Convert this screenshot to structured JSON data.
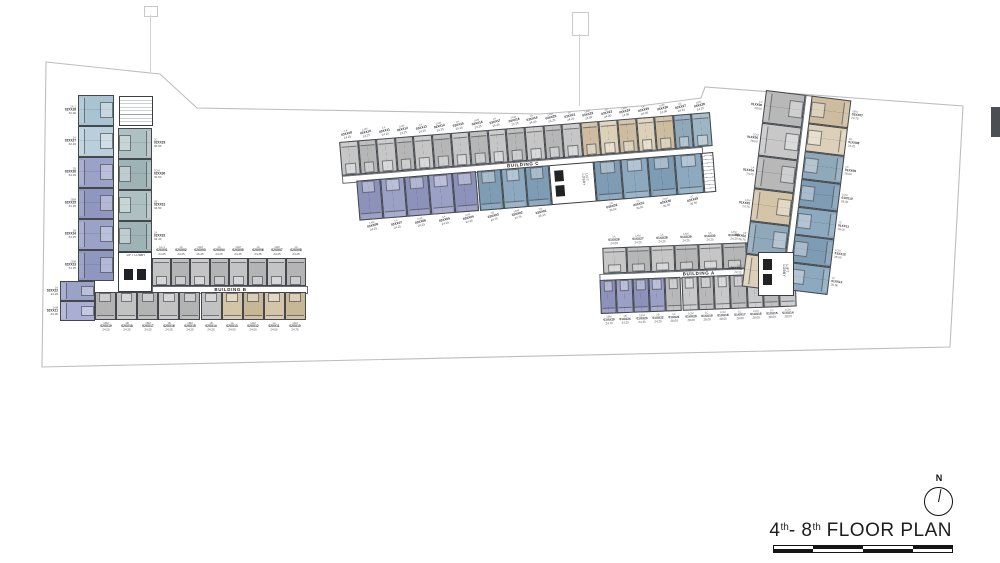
{
  "title": {
    "n1": "4",
    "s1": "th",
    "n2": "- 8",
    "s2": "th",
    "rest": " FLOOR PLAN"
  },
  "compass": {
    "north": "N"
  },
  "buildings": {
    "b": {
      "label": "BUILDING B",
      "lobby_label": "LIFT LOBBY",
      "left_units": [
        {
          "type": "2A-1",
          "no": "02XX28",
          "area": "32.00",
          "color": "#a9c3d2"
        },
        {
          "type": "2A",
          "no": "02XX27",
          "area": "32.40",
          "color": "#b9cfdc"
        },
        {
          "type": "2B",
          "no": "02XX26",
          "area": "34.25",
          "color": "#9aa2c8"
        },
        {
          "type": "2BM",
          "no": "02XX25",
          "area": "34.25",
          "color": "#8f96c0"
        },
        {
          "type": "2B",
          "no": "02XX24",
          "area": "34.25",
          "color": "#9aa2c8"
        },
        {
          "type": "2BM",
          "no": "02XX23",
          "area": "34.25",
          "color": "#8f96c0"
        }
      ],
      "corner_units": [
        {
          "type": "1A",
          "no": "02XX22",
          "area": "24.25",
          "color": "#9aa2c8"
        },
        {
          "type": "1AM",
          "no": "02XX21",
          "area": "24.00",
          "color": "#a9aed2"
        }
      ],
      "right_units": [
        {
          "type": "2C",
          "no": "02XX29",
          "area": "30.50",
          "color": "#aec0c1"
        },
        {
          "type": "2CM",
          "no": "02XX30",
          "area": "30.50",
          "color": "#9db3b6"
        },
        {
          "type": "2B",
          "no": "02XX31",
          "area": "34.50",
          "color": "#aec0c1"
        },
        {
          "type": "2A",
          "no": "02XX32",
          "area": "32.40",
          "color": "#9db3b6"
        }
      ],
      "top_row": [
        {
          "type": "1A-1",
          "no": "02XX01",
          "area": "24.25",
          "color": "#c4c4c4"
        },
        {
          "type": "1A",
          "no": "02XX02",
          "area": "24.25",
          "color": "#b4b4b4"
        },
        {
          "type": "1AM",
          "no": "02XX03",
          "area": "26.25",
          "color": "#c4c4c4"
        },
        {
          "type": "1A",
          "no": "02XX04",
          "area": "24.25",
          "color": "#b4b4b4"
        },
        {
          "type": "1AM",
          "no": "02XX05",
          "area": "24.25",
          "color": "#c4c4c4"
        },
        {
          "type": "1A",
          "no": "02XX06",
          "area": "24.25",
          "color": "#b4b4b4"
        },
        {
          "type": "1AM",
          "no": "02XX07",
          "area": "24.25",
          "color": "#c4c4c4"
        },
        {
          "type": "1A",
          "no": "02XX08",
          "area": "24.25",
          "color": "#b4b4b4"
        }
      ],
      "bottom_row": [
        {
          "type": "1BM",
          "no": "02XX19",
          "area": "24.25",
          "color": "#b3b3b3"
        },
        {
          "type": "1B",
          "no": "02XX18",
          "area": "24.25",
          "color": "#c2c2c2"
        },
        {
          "type": "1BM",
          "no": "02XX17",
          "area": "24.25",
          "color": "#b3b3b3"
        },
        {
          "type": "1B",
          "no": "02XX16",
          "area": "24.25",
          "color": "#c2c2c2"
        },
        {
          "type": "1BM",
          "no": "02XX15",
          "area": "24.25",
          "color": "#b3b3b3"
        },
        {
          "type": "1B",
          "no": "02XX14",
          "area": "24.25",
          "color": "#c2c2c2"
        },
        {
          "type": "1A",
          "no": "02XX13",
          "area": "24.00",
          "color": "#d5c5a8"
        },
        {
          "type": "1AM",
          "no": "02XX12",
          "area": "24.00",
          "color": "#c8b795"
        },
        {
          "type": "1A",
          "no": "02XX11",
          "area": "24.00",
          "color": "#d5c5a8"
        },
        {
          "type": "1AM",
          "no": "02XX10",
          "area": "24.75",
          "color": "#c8b795"
        }
      ]
    },
    "c": {
      "label": "BUILDING C",
      "lobby_label": "LIFT LOBBY",
      "top_row": [
        {
          "type": "1A",
          "no": "03XX09",
          "area": "24.25",
          "color": "#c6c6c6"
        },
        {
          "type": "1AM",
          "no": "03XX10",
          "area": "24.25",
          "color": "#b6b6b6"
        },
        {
          "type": "1A",
          "no": "03XX11",
          "area": "24.25",
          "color": "#c6c6c6"
        },
        {
          "type": "1AM",
          "no": "03XX12",
          "area": "24.25",
          "color": "#b6b6b6"
        },
        {
          "type": "1A",
          "no": "03XX13",
          "area": "24.25",
          "color": "#c6c6c6"
        },
        {
          "type": "1AM",
          "no": "03XX14",
          "area": "24.25",
          "color": "#b6b6b6"
        },
        {
          "type": "1A",
          "no": "03XX15",
          "area": "24.25",
          "color": "#c6c6c6"
        },
        {
          "type": "1AM",
          "no": "03XX16",
          "area": "24.25",
          "color": "#b6b6b6"
        },
        {
          "type": "1A",
          "no": "03XX17",
          "area": "24.25",
          "color": "#c6c6c6"
        },
        {
          "type": "1AM",
          "no": "03XX18",
          "area": "24.25",
          "color": "#b6b6b6"
        },
        {
          "type": "1A",
          "no": "03XX19",
          "area": "24.25",
          "color": "#c6c6c6"
        },
        {
          "type": "1AM",
          "no": "03XX20",
          "area": "24.25",
          "color": "#b6b6b6"
        },
        {
          "type": "1A",
          "no": "03XX21",
          "area": "24.25",
          "color": "#c6c6c6"
        },
        {
          "type": "1AM",
          "no": "03XX22",
          "area": "24.00",
          "color": "#cdbc9f"
        },
        {
          "type": "1A",
          "no": "03XX23",
          "area": "24.00",
          "color": "#ddd0b8"
        },
        {
          "type": "1AM",
          "no": "03XX24",
          "area": "24.00",
          "color": "#cdbc9f"
        },
        {
          "type": "1A",
          "no": "03XX25",
          "area": "24.00",
          "color": "#ddd0b8"
        },
        {
          "type": "1AM",
          "no": "03XX26",
          "area": "24.00",
          "color": "#cdbc9f"
        },
        {
          "type": "1B",
          "no": "03XX27",
          "area": "24.25",
          "color": "#8fa9ba"
        },
        {
          "type": "1BM",
          "no": "03XX28",
          "area": "24.25",
          "color": "#9db6c4"
        }
      ],
      "bottom_left": [
        {
          "type": "1AM",
          "no": "03XX08",
          "area": "24.25",
          "color": "#8d92bb"
        },
        {
          "type": "1A",
          "no": "03XX07",
          "area": "24.25",
          "color": "#9aa0c6"
        },
        {
          "type": "1AM",
          "no": "03XX06",
          "area": "24.25",
          "color": "#8d92bb"
        },
        {
          "type": "1A",
          "no": "03XX05",
          "area": "24.25",
          "color": "#9aa0c6"
        },
        {
          "type": "1AM",
          "no": "03XX04",
          "area": "24.25",
          "color": "#8d92bb"
        },
        {
          "type": "1B",
          "no": "03XX03",
          "area": "24.75",
          "color": "#7e9cb4"
        },
        {
          "type": "1BM",
          "no": "03XX02",
          "area": "24.75",
          "color": "#8ca9bf"
        },
        {
          "type": "2B",
          "no": "03XX01",
          "area": "26.25",
          "color": "#7e9cb4"
        }
      ],
      "bottom_right": [
        {
          "type": "2C",
          "no": "03XX32",
          "area": "30.50",
          "color": "#7e9cb4"
        },
        {
          "type": "2C",
          "no": "03XX31",
          "area": "30.50",
          "color": "#8ca9bf"
        },
        {
          "type": "2CM",
          "no": "03XX30",
          "area": "30.50",
          "color": "#7e9cb4"
        },
        {
          "type": "2C",
          "no": "03XX29",
          "area": "30.50",
          "color": "#8ca9bf"
        }
      ]
    },
    "a": {
      "label": "BUILDING A",
      "lobby_label": "LIFT LOBBY",
      "bar_top": [
        {
          "type": "1A",
          "no": "01XX26",
          "area": "24.00",
          "color": "#c6c6c6"
        },
        {
          "type": "1AM",
          "no": "01XX27",
          "area": "24.25",
          "color": "#b6b6b6"
        },
        {
          "type": "1A",
          "no": "01XX28",
          "area": "24.25",
          "color": "#c6c6c6"
        },
        {
          "type": "1AM",
          "no": "01XX29",
          "area": "24.25",
          "color": "#b6b6b6"
        },
        {
          "type": "1A",
          "no": "01XX30",
          "area": "24.25",
          "color": "#c6c6c6"
        },
        {
          "type": "1AM",
          "no": "01XX31",
          "area": "24.25",
          "color": "#b6b6b6"
        },
        {
          "type": "1B",
          "no": "01XX32",
          "area": "24.75",
          "color": "#8fa9ba"
        },
        {
          "type": "1BM",
          "no": "01XX33",
          "area": "24.75",
          "color": "#d5c5a8"
        }
      ],
      "bar_bottom": [
        {
          "type": "1BM",
          "no": "01XX25",
          "area": "24.75",
          "color": "#8d92bb"
        },
        {
          "type": "1B",
          "no": "01XX24",
          "area": "24.25",
          "color": "#9aa0c6"
        },
        {
          "type": "1BM",
          "no": "01XX23",
          "area": "24.25",
          "color": "#8d92bb"
        },
        {
          "type": "1B",
          "no": "01XX22",
          "area": "24.25",
          "color": "#9aa0c6"
        },
        {
          "type": "1C",
          "no": "01XX21",
          "area": "28.00",
          "color": "#b8b8b8"
        },
        {
          "type": "1CM",
          "no": "01XX20",
          "area": "28.00",
          "color": "#c8c8c8"
        },
        {
          "type": "1C",
          "no": "01XX19",
          "area": "28.00",
          "color": "#b8b8b8"
        },
        {
          "type": "1CM",
          "no": "01XX18",
          "area": "28.00",
          "color": "#c8c8c8"
        },
        {
          "type": "1C",
          "no": "01XX17",
          "area": "28.00",
          "color": "#b8b8b8"
        },
        {
          "type": "1CM",
          "no": "01XX16",
          "area": "28.00",
          "color": "#c8c8c8"
        },
        {
          "type": "1C",
          "no": "01XX15",
          "area": "28.00",
          "color": "#b8b8b8"
        },
        {
          "type": "1CM",
          "no": "01XX14",
          "area": "28.00",
          "color": "#c8c8c8"
        }
      ],
      "wing_left": [
        {
          "type": "1C",
          "no": "01XX06",
          "area": "28.00",
          "color": "#b8b8b8"
        },
        {
          "type": "1CM",
          "no": "01XX05",
          "area": "28.00",
          "color": "#c8c8c8"
        },
        {
          "type": "1A",
          "no": "01XX04",
          "area": "24.25",
          "color": "#b8b8b8"
        },
        {
          "type": "1AM",
          "no": "01XX03",
          "area": "24.75",
          "color": "#d5c5a8"
        },
        {
          "type": "1B",
          "no": "01XX02",
          "area": "28.75",
          "color": "#8fa9ba"
        },
        {
          "type": "1A-1",
          "no": "01XX01",
          "area": "24.25",
          "color": "#ddd0b8"
        }
      ],
      "wing_right": [
        {
          "type": "1BM",
          "no": "01XX07",
          "area": "24.75",
          "color": "#cdbc9f"
        },
        {
          "type": "1B",
          "no": "01XX08",
          "area": "24.75",
          "color": "#ddd0b8"
        },
        {
          "type": "1C",
          "no": "01XX09",
          "area": "28.00",
          "color": "#8fa9ba"
        },
        {
          "type": "1CM",
          "no": "01XX10",
          "area": "28.00",
          "color": "#7e9cb4"
        },
        {
          "type": "1C",
          "no": "01XX11",
          "area": "28.00",
          "color": "#8ca9bf"
        },
        {
          "type": "1CM",
          "no": "01XX12",
          "area": "28.00",
          "color": "#7e9cb4"
        },
        {
          "type": "1C",
          "no": "01XX13",
          "area": "28.50",
          "color": "#8ca9bf"
        }
      ]
    }
  }
}
